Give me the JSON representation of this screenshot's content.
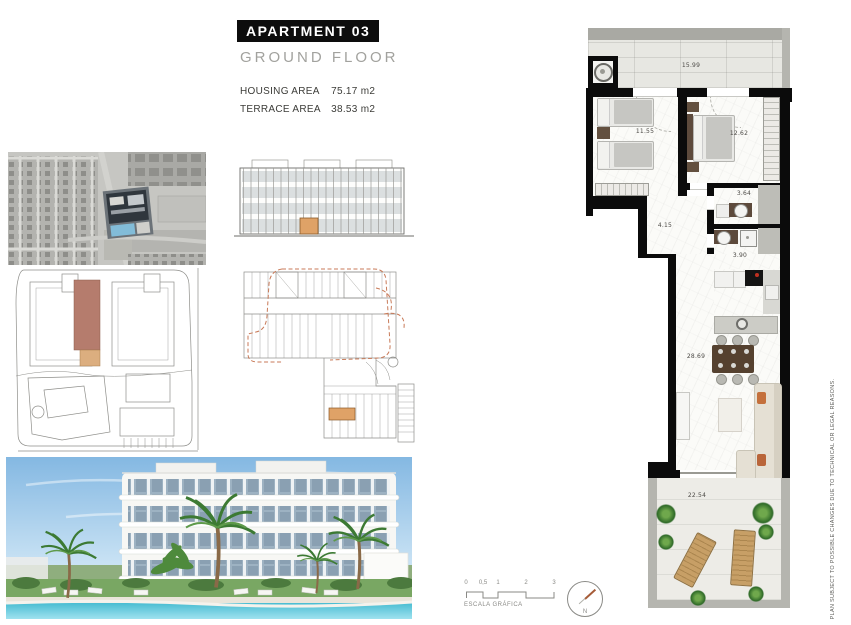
{
  "header": {
    "apartment_title": "APARTMENT 03",
    "floor_title": "GROUND FLOOR",
    "housing_area_label": "HOUSING AREA",
    "housing_area_value": "75.17 m2",
    "terrace_area_label": "TERRACE AREA",
    "terrace_area_value": "38.53 m2"
  },
  "floor_plan": {
    "areas": {
      "terrace_top": "15.99",
      "bedroom_1": "11.55",
      "bedroom_2": "12.62",
      "bathroom_1": "3.64",
      "hallway": "4.15",
      "bathroom_2": "3.90",
      "living_kitchen": "28.69",
      "terrace_bottom": "22.54"
    }
  },
  "footer": {
    "scale_ticks": [
      "0",
      "0,5",
      "1",
      "2",
      "3"
    ],
    "scale_label": "ESCALA GRÁFICA",
    "north_label": "N"
  },
  "disclaimer": "PLAN SUBJECT TO POSSIBLE CHANGES DUE TO TECHNICAL OR LEGAL REASONS.",
  "colors": {
    "unit_highlight_dark": "#b57c6d",
    "unit_highlight_light": "#dcae7f",
    "elevation_highlight": "#dfa267",
    "wall": "#0b0b0b",
    "north_needle": "#a65c38"
  }
}
